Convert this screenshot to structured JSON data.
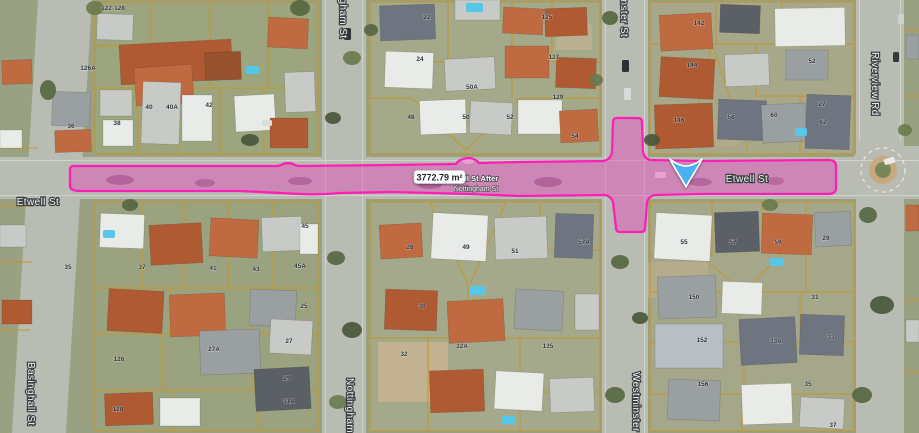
{
  "map": {
    "streets": {
      "etwell_left": "Etwell St",
      "etwell_right": "Etwell St",
      "nottingham_top": "Nottingham St",
      "nottingham_bottom": "Nottingham St",
      "westminster_top": "Westminster St",
      "westminster_bottom": "Westminster St",
      "basinghall": "Basinghall St",
      "riverview": "Riverview Rd"
    },
    "measurement": {
      "area_label": "3772.79 m²",
      "segment_line1": "Etwell St After",
      "segment_line2": "Nottingham St"
    },
    "colors": {
      "selection_stroke": "#ff1fb7",
      "selection_fill": "rgba(233,62,188,0.42)",
      "parcel_line": "#c8941f",
      "road": "#b9bcb2",
      "marker_blue": "#49b0f2"
    },
    "lots": [
      {
        "x": 113,
        "y": 10,
        "t": "122-128"
      },
      {
        "x": 88,
        "y": 70,
        "t": "126A"
      },
      {
        "x": 71,
        "y": 128,
        "t": "36"
      },
      {
        "x": 117,
        "y": 125,
        "t": "38"
      },
      {
        "x": 149,
        "y": 109,
        "t": "40"
      },
      {
        "x": 172,
        "y": 109,
        "t": "40A"
      },
      {
        "x": 209,
        "y": 107,
        "t": "42"
      },
      {
        "x": 427,
        "y": 19,
        "t": "22"
      },
      {
        "x": 547,
        "y": 19,
        "t": "125"
      },
      {
        "x": 420,
        "y": 61,
        "t": "24"
      },
      {
        "x": 554,
        "y": 59,
        "t": "127"
      },
      {
        "x": 472,
        "y": 89,
        "t": "50A"
      },
      {
        "x": 558,
        "y": 99,
        "t": "129"
      },
      {
        "x": 411,
        "y": 119,
        "t": "48"
      },
      {
        "x": 466,
        "y": 119,
        "t": "50"
      },
      {
        "x": 510,
        "y": 119,
        "t": "52"
      },
      {
        "x": 575,
        "y": 138,
        "t": "54"
      },
      {
        "x": 699,
        "y": 25,
        "t": "142"
      },
      {
        "x": 692,
        "y": 67,
        "t": "144"
      },
      {
        "x": 679,
        "y": 122,
        "t": "146"
      },
      {
        "x": 812,
        "y": 63,
        "t": "52"
      },
      {
        "x": 731,
        "y": 119,
        "t": "58"
      },
      {
        "x": 774,
        "y": 117,
        "t": "60"
      },
      {
        "x": 822,
        "y": 106,
        "t": "27"
      },
      {
        "x": 823,
        "y": 124,
        "t": "62"
      },
      {
        "x": 68,
        "y": 269,
        "t": "35"
      },
      {
        "x": 142,
        "y": 269,
        "t": "37"
      },
      {
        "x": 213,
        "y": 270,
        "t": "41"
      },
      {
        "x": 256,
        "y": 271,
        "t": "43"
      },
      {
        "x": 305,
        "y": 228,
        "t": "45"
      },
      {
        "x": 300,
        "y": 268,
        "t": "45A"
      },
      {
        "x": 304,
        "y": 308,
        "t": "25"
      },
      {
        "x": 119,
        "y": 361,
        "t": "126"
      },
      {
        "x": 214,
        "y": 351,
        "t": "27A"
      },
      {
        "x": 289,
        "y": 343,
        "t": "27"
      },
      {
        "x": 287,
        "y": 380,
        "t": "29"
      },
      {
        "x": 289,
        "y": 403,
        "t": "31A"
      },
      {
        "x": 118,
        "y": 411,
        "t": "128"
      },
      {
        "x": 410,
        "y": 249,
        "t": "28"
      },
      {
        "x": 466,
        "y": 249,
        "t": "49"
      },
      {
        "x": 515,
        "y": 253,
        "t": "51"
      },
      {
        "x": 584,
        "y": 244,
        "t": "57A"
      },
      {
        "x": 422,
        "y": 308,
        "t": "30"
      },
      {
        "x": 404,
        "y": 356,
        "t": "32"
      },
      {
        "x": 462,
        "y": 348,
        "t": "32A"
      },
      {
        "x": 548,
        "y": 348,
        "t": "135"
      },
      {
        "x": 684,
        "y": 244,
        "t": "55"
      },
      {
        "x": 733,
        "y": 244,
        "t": "57"
      },
      {
        "x": 778,
        "y": 244,
        "t": "59"
      },
      {
        "x": 826,
        "y": 240,
        "t": "29"
      },
      {
        "x": 694,
        "y": 299,
        "t": "150"
      },
      {
        "x": 815,
        "y": 299,
        "t": "31"
      },
      {
        "x": 702,
        "y": 342,
        "t": "152"
      },
      {
        "x": 776,
        "y": 343,
        "t": "33A"
      },
      {
        "x": 831,
        "y": 339,
        "t": "33"
      },
      {
        "x": 703,
        "y": 386,
        "t": "156"
      },
      {
        "x": 808,
        "y": 386,
        "t": "35"
      },
      {
        "x": 833,
        "y": 427,
        "t": "37"
      }
    ]
  }
}
